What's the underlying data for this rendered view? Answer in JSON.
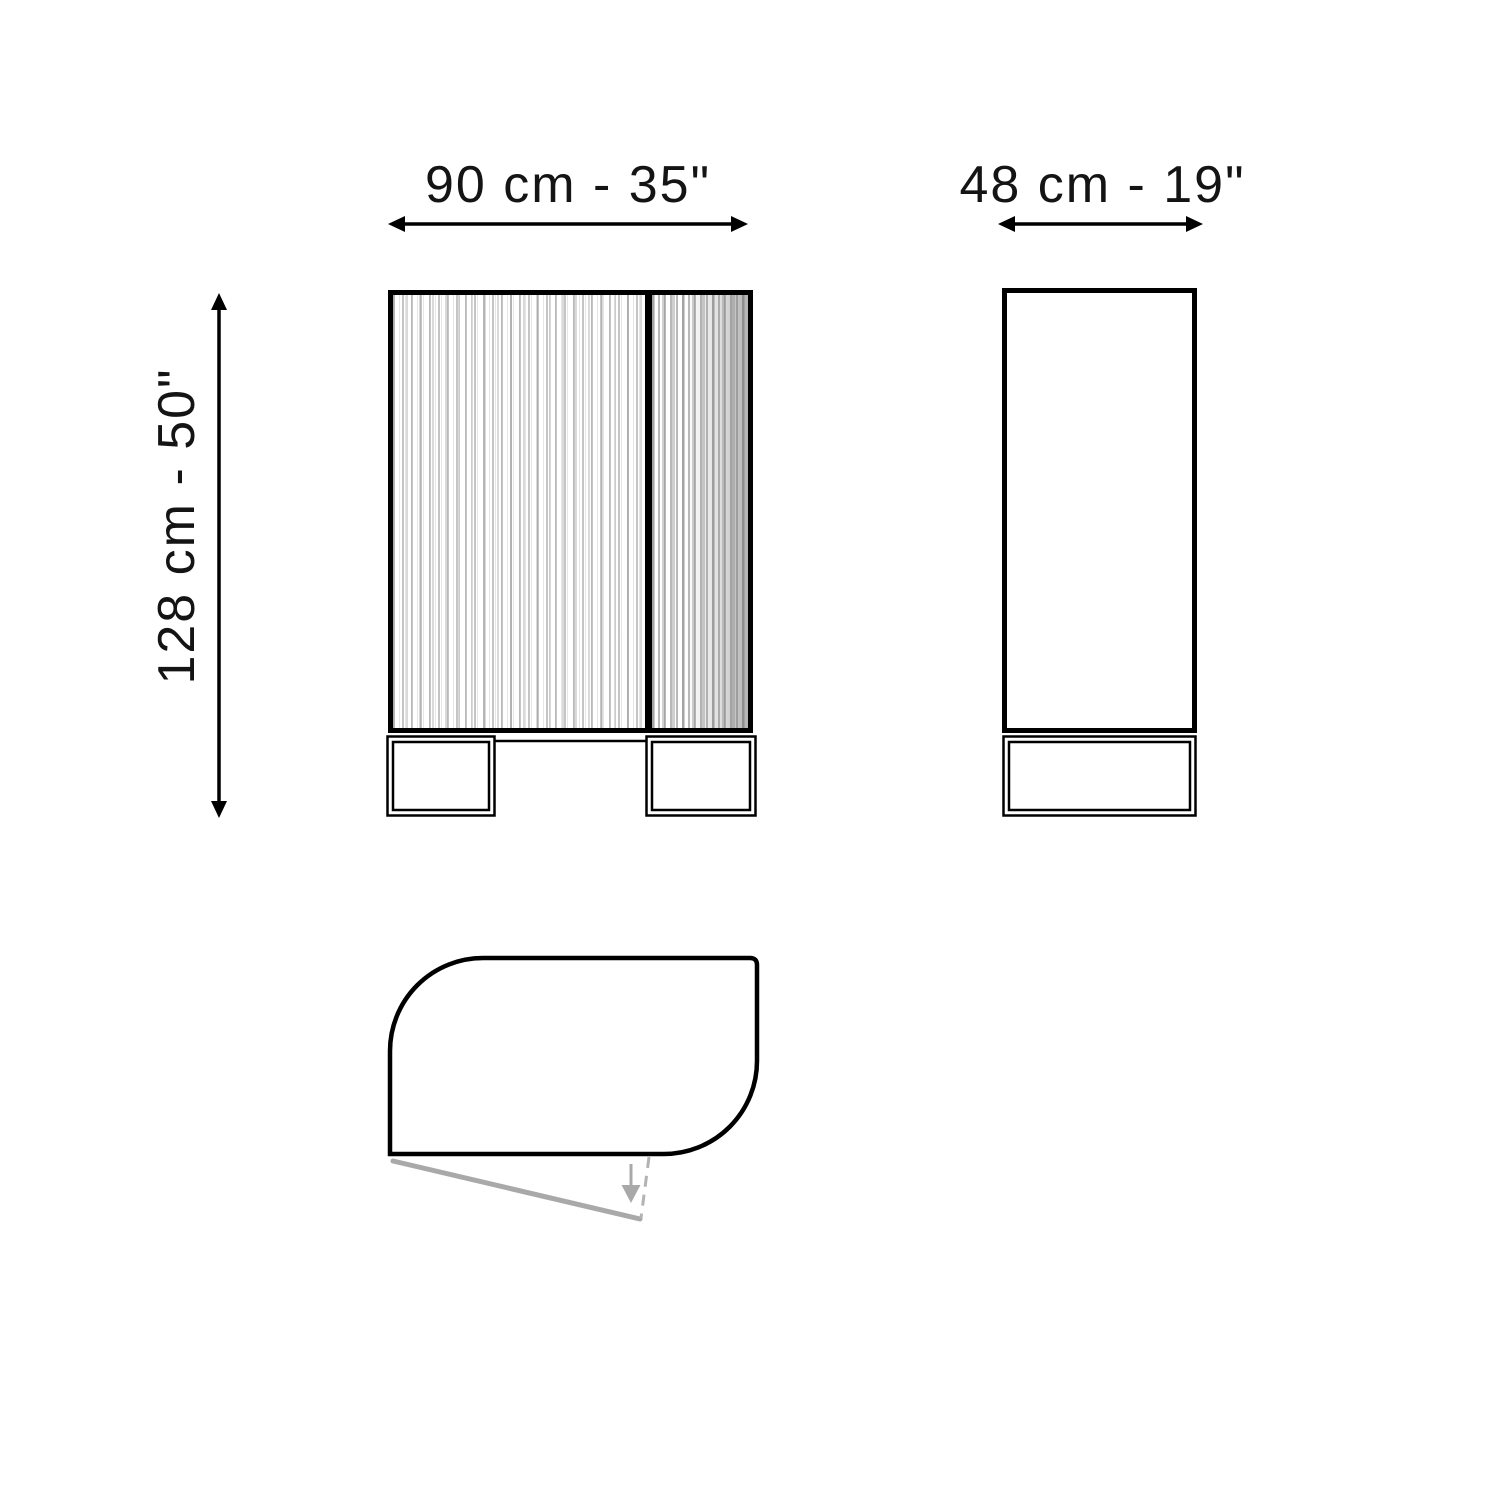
{
  "dimensions": {
    "width_label": "90 cm - 35\"",
    "depth_label": "48 cm - 19\"",
    "height_label": "128 cm - 50\""
  },
  "colors": {
    "line": "#000000",
    "swing_gray": "#a9a9a9",
    "flute_gray_light": "#c9c9c9",
    "flute_gray_dark": "#9e9e9e",
    "background": "#ffffff"
  }
}
